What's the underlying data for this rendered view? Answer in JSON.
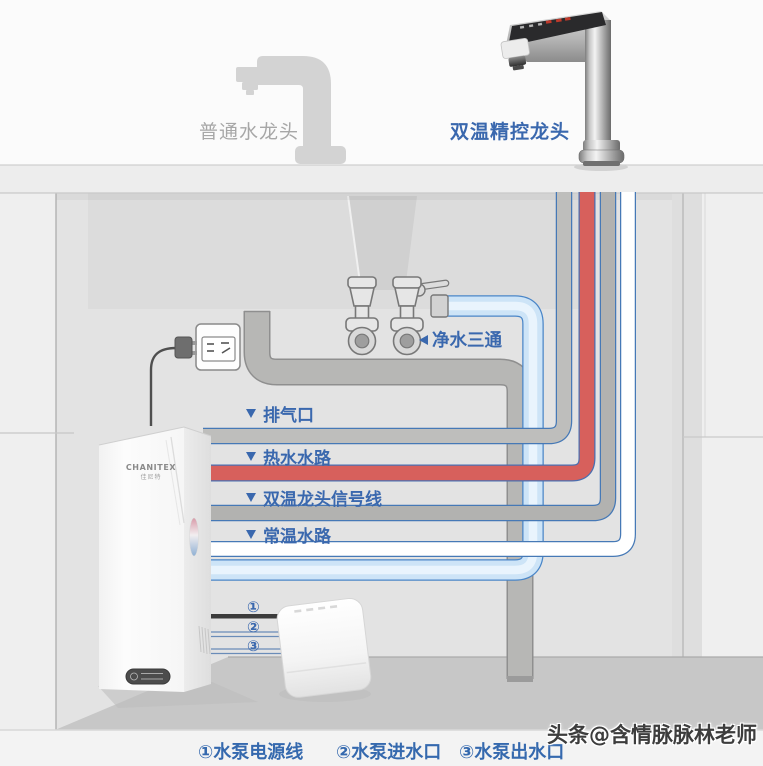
{
  "faucets": {
    "ordinary_label": "普通水龙头",
    "smart_label": "双温精控龙头"
  },
  "tee": {
    "label": "净水三通"
  },
  "pipes": [
    {
      "id": "air-vent",
      "label": "排气口",
      "color": "#bebebc"
    },
    {
      "id": "hot-water",
      "label": "热水水路",
      "color": "#d7605c"
    },
    {
      "id": "signal-line",
      "label": "双温龙头信号线",
      "color": "#b2b2b0"
    },
    {
      "id": "ambient-water",
      "label": "常温水路",
      "color": "#ffffff"
    }
  ],
  "device": {
    "brand": "CHANITEX",
    "sub_brand": "佳尼特"
  },
  "pump": {
    "callouts": [
      "①",
      "②",
      "③"
    ]
  },
  "legend": {
    "items": [
      "①水泵电源线",
      "②水泵进水口",
      "③水泵出水口"
    ]
  },
  "watermark": "头条@含情脉脉林老师",
  "colors": {
    "label_blue": "#3a68ae",
    "pipe_outline_blue": "#4679b6",
    "hot_pipe": "#d7605c",
    "feed_pipe": "#cde4f7",
    "drain_pipe": "#b7b7b5",
    "floor": "#c7c7c7"
  }
}
